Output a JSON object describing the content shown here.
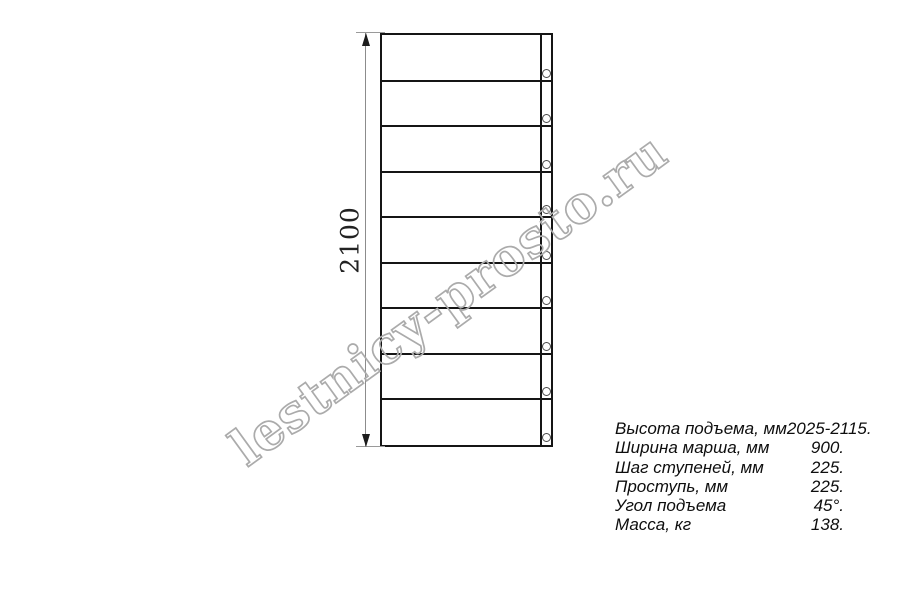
{
  "watermark": {
    "text": "lestnicy-prosto.ru"
  },
  "diagram": {
    "dimension_label": "2100",
    "treads": 9,
    "step_lines": 8,
    "holes": 9,
    "direction_arrow": "up"
  },
  "specs": {
    "rows": [
      {
        "label": "Высота подъема, мм",
        "value": "2025-2115."
      },
      {
        "label": "Ширина марша, мм",
        "value": "900."
      },
      {
        "label": "Шаг ступеней, мм",
        "value": "225."
      },
      {
        "label": "Проступь, мм",
        "value": "225."
      },
      {
        "label": "Угол подъема",
        "value": "45°."
      },
      {
        "label": "Масса, кг",
        "value": "138."
      }
    ]
  },
  "colors": {
    "line": "#151515",
    "dimension": "#8c8c8c",
    "watermark_outline": "#ababab",
    "arrow_fill": "#dcdcdc",
    "background": "#ffffff"
  }
}
